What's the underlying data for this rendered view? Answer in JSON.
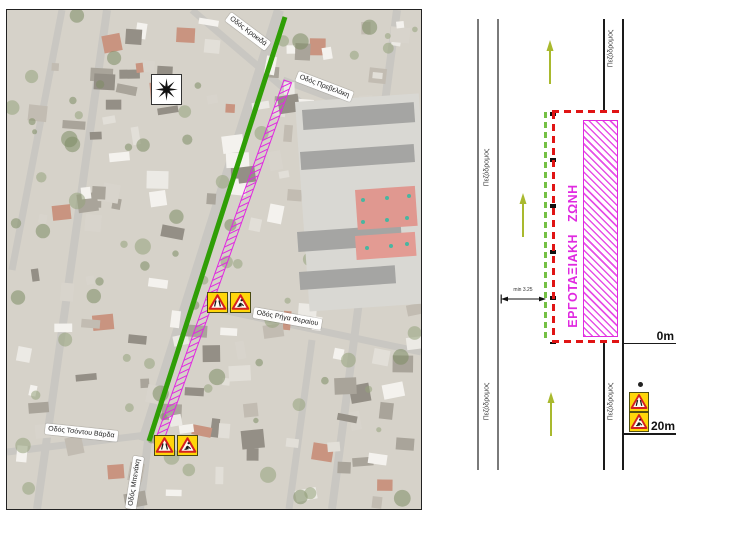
{
  "map": {
    "street_labels": [
      {
        "text": "Οδός Κροκιδά"
      },
      {
        "text": "Οδός Πρεβελάκη"
      },
      {
        "text": "Οδός Ρήγα Φεραίου"
      },
      {
        "text": "Οδός Τσόντου Βάρδα"
      },
      {
        "text": "Οδός Μπενάκη"
      }
    ],
    "north_symbol": "compass-star-8point",
    "legend_colors": {
      "closed_street": "#2f9e06",
      "work_zone": "#e02ae0"
    },
    "warning_signs": [
      {
        "type": "road-narrows"
      },
      {
        "type": "road-works"
      }
    ]
  },
  "diagram": {
    "sidewalk_label": "Πεζόδρομος",
    "work_zone_label": "ΕΡΓΟΤΑΞΙΑΚΗ ΖΩΝΗ",
    "dimension_label": "min 3.25",
    "markers": {
      "start": "0m",
      "sign_distance": "20m"
    },
    "arrow_color": "#a9b92e",
    "barrier_color": "#e01414",
    "lane_edge_color": "#7a7a7a",
    "sign_plate_color": "#ffd60a"
  }
}
